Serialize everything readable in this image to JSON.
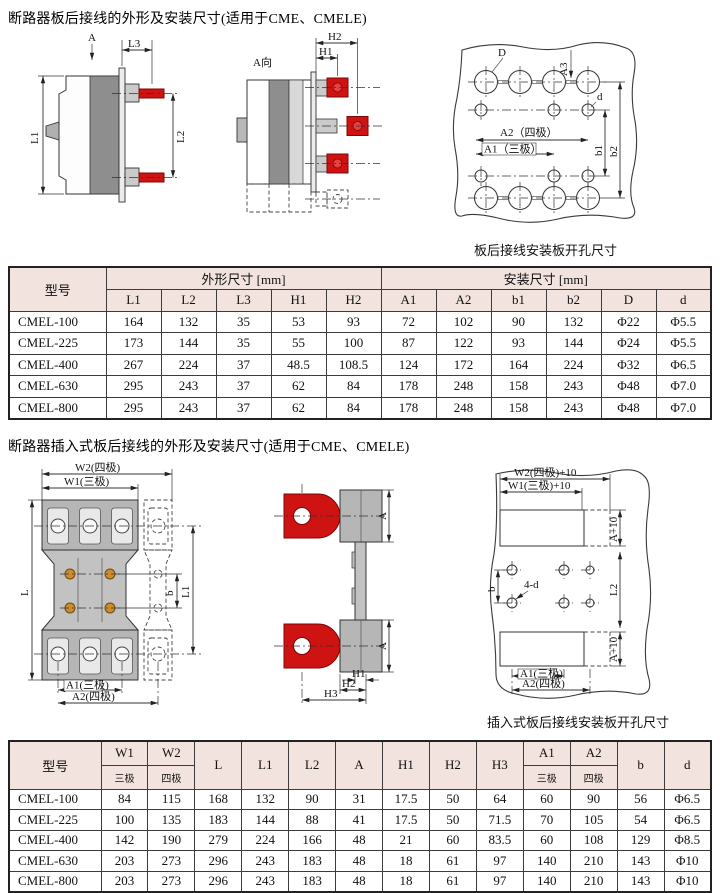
{
  "s1": {
    "title": "断路器板后接线的外形及安装尺寸(适用于CME、CMELE)",
    "side": {
      "a": "A",
      "l1": "L1",
      "l2": "L2",
      "l3": "L3"
    },
    "aview": {
      "title": "A向",
      "h1": "H1",
      "h2": "H2"
    },
    "plate": {
      "d_big": "D",
      "a3": "A3",
      "d_small": "d",
      "a2": "A2（四极）",
      "a1": "A1（三极）",
      "b1": "b1",
      "b2": "b2"
    },
    "plate_caption": "板后接线安装板开孔尺寸",
    "table": {
      "model_header": "型号",
      "group_outline": "外形尺寸 [mm]",
      "group_install": "安装尺寸 [mm]",
      "cols": [
        "L1",
        "L2",
        "L3",
        "H1",
        "H2",
        "A1",
        "A2",
        "b1",
        "b2",
        "D",
        "d"
      ],
      "rows": [
        [
          "CMEL-100",
          "164",
          "132",
          "35",
          "53",
          "93",
          "72",
          "102",
          "90",
          "132",
          "Φ22",
          "Φ5.5"
        ],
        [
          "CMEL-225",
          "173",
          "144",
          "35",
          "55",
          "100",
          "87",
          "122",
          "93",
          "144",
          "Φ24",
          "Φ5.5"
        ],
        [
          "CMEL-400",
          "267",
          "224",
          "37",
          "48.5",
          "108.5",
          "124",
          "172",
          "164",
          "224",
          "Φ32",
          "Φ6.5"
        ],
        [
          "CMEL-630",
          "295",
          "243",
          "37",
          "62",
          "84",
          "178",
          "248",
          "158",
          "243",
          "Φ48",
          "Φ7.0"
        ],
        [
          "CMEL-800",
          "295",
          "243",
          "37",
          "62",
          "84",
          "178",
          "248",
          "158",
          "243",
          "Φ48",
          "Φ7.0"
        ]
      ]
    }
  },
  "s2": {
    "title": "断路器插入式板后接线的外形及安装尺寸(适用于CME、CMELE)",
    "front": {
      "w2": "W2(四极)",
      "w1": "W1(三极)",
      "l": "L",
      "b": "b",
      "l1": "L1",
      "a1": "A1(三极)",
      "a2": "A2(四极)"
    },
    "side": {
      "a": "A",
      "h1": "H1",
      "h2": "H2",
      "h3": "H3"
    },
    "plate": {
      "w2p10": "W2(四极)+10",
      "w1p10": "W1(三极)+10",
      "a10": "A+10",
      "b": "b",
      "holes": "4-d",
      "l2": "L2",
      "a1": "A1(三极)",
      "a2": "A2(四极)"
    },
    "plate_caption": "插入式板后接线安装板开孔尺寸",
    "table": {
      "model_header": "型号",
      "w1": "W1",
      "w2": "W2",
      "a1": "A1",
      "a2": "A2",
      "b": "b",
      "d": "d",
      "three_pole": "三极",
      "four_pole": "四极",
      "cols_mid": [
        "L",
        "L1",
        "L2",
        "A",
        "H1",
        "H2",
        "H3"
      ],
      "rows": [
        [
          "CMEL-100",
          "84",
          "115",
          "168",
          "132",
          "90",
          "31",
          "17.5",
          "50",
          "64",
          "60",
          "90",
          "56",
          "Φ6.5"
        ],
        [
          "CMEL-225",
          "100",
          "135",
          "183",
          "144",
          "88",
          "41",
          "17.5",
          "50",
          "71.5",
          "70",
          "105",
          "54",
          "Φ6.5"
        ],
        [
          "CMEL-400",
          "142",
          "190",
          "279",
          "224",
          "166",
          "48",
          "21",
          "60",
          "83.5",
          "60",
          "108",
          "129",
          "Φ8.5"
        ],
        [
          "CMEL-630",
          "203",
          "273",
          "296",
          "243",
          "183",
          "48",
          "18",
          "61",
          "97",
          "140",
          "210",
          "143",
          "Φ10"
        ],
        [
          "CMEL-800",
          "203",
          "273",
          "296",
          "243",
          "183",
          "48",
          "18",
          "61",
          "97",
          "140",
          "210",
          "143",
          "Φ10"
        ]
      ]
    }
  },
  "colors": {
    "header_bg": "#f3e3df",
    "terminal_red": "#cf1212",
    "screw_orange": "#cd8c2d"
  }
}
